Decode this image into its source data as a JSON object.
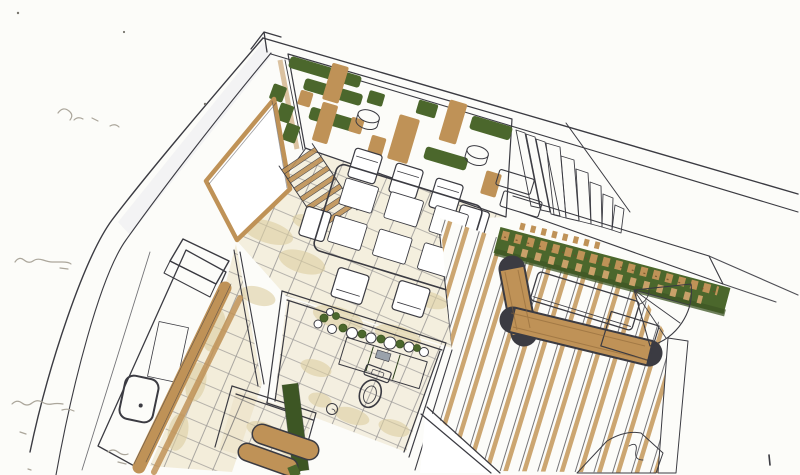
{
  "sketch": {
    "kind": "hand-drawn interior perspective sketch, marker and ink on white paper",
    "legible_text": false,
    "margin_notes": {
      "legible": false,
      "count": 4,
      "positions": [
        "upper-left",
        "mid-left",
        "lower-left",
        "bottom-left"
      ]
    }
  },
  "palette": {
    "paper": "#fcfcf9",
    "ink": "#3b3b42",
    "ink_soft": "#8b8b94",
    "pencil": "#aba69b",
    "green": "#4b672c",
    "green_dark": "#3d5624",
    "tan": "#bf9257",
    "tan_light": "#c9a169",
    "beige": "#e9ddbb",
    "beige_dark": "#ddcfa2",
    "gray_shade": "#dcdde3",
    "glass_shade": "#e9e9ee"
  },
  "scene": {
    "areas": [
      {
        "label": "living room wall with shelves and plants"
      },
      {
        "label": "staircase"
      },
      {
        "label": "glass door in left wall"
      },
      {
        "label": "dining table with six place settings and chairs"
      },
      {
        "label": "kitchen counter with sink and stove"
      },
      {
        "label": "bathroom with toilet and planted vanity"
      },
      {
        "label": "hallway bench with green runner"
      },
      {
        "label": "terrace wood deck"
      },
      {
        "label": "planting bed with wood chips"
      },
      {
        "label": "terrace bench and table"
      },
      {
        "label": "fan-shaped terrace steps"
      },
      {
        "label": "illegible pencil margin notes"
      }
    ]
  }
}
